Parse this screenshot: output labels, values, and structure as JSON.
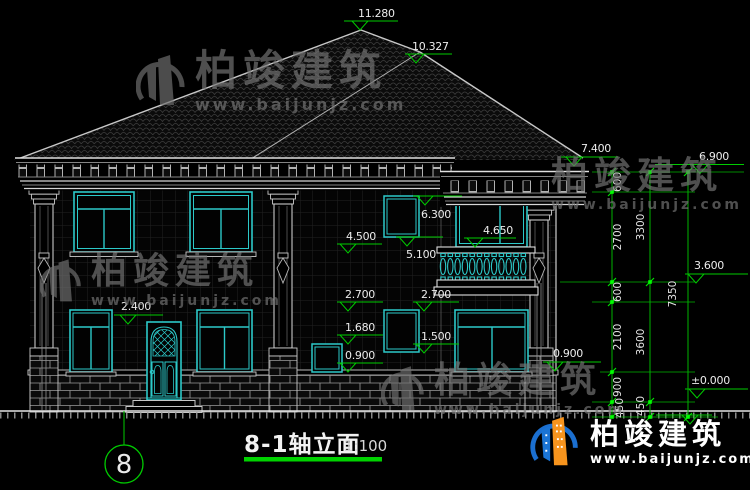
{
  "drawing": {
    "title": "8-1轴立面",
    "scale": "1:100",
    "axis_bubble": "8",
    "levels": {
      "ridge_main": "11.280",
      "ridge_side": "10.327",
      "eave_main": "7.400",
      "eave_side": "6.900",
      "win_head_2f": "6.300",
      "stair_win_sill": "5.100",
      "balcony_win_sill": "4.650",
      "win_sill_2f": "4.500",
      "floor_2f": "3.600",
      "win_head_1f_left": "2.700",
      "win_head_1f_right": "2.700",
      "door_head": "2.400",
      "small_win_head": "1.680",
      "stair_low_win_sill": "1.500",
      "win_sill_1f": "0.900",
      "win_sill_1f_right": "0.900",
      "ground_floor": "±0.000"
    },
    "dimensions": {
      "inner_chain": [
        "600",
        "2700",
        "600",
        "2100",
        "900",
        "450"
      ],
      "middle_chain": [
        "3300",
        "3600",
        "450"
      ],
      "overall": "7350"
    },
    "colors": {
      "dim_green": "#00d000",
      "window_teal": "#2cc9c9",
      "line_white": "#cccccc",
      "logo_blue": "#1b6fd0",
      "logo_orange": "#f7941d"
    }
  },
  "watermark": {
    "brand": "柏竣建筑",
    "url": "www.baijunjz.com"
  }
}
